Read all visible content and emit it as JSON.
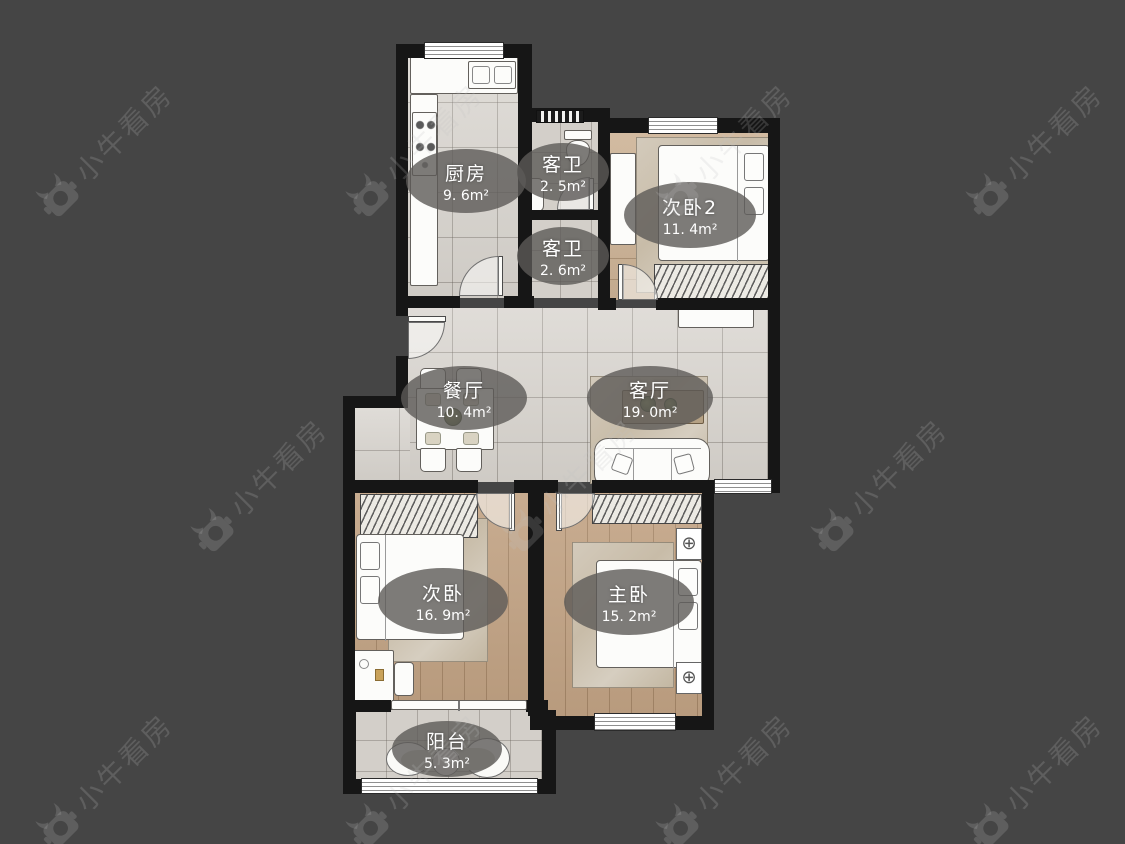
{
  "watermark": {
    "text": "小牛看房",
    "logo_icon": "bull-head-logo"
  },
  "rooms": {
    "kitchen": {
      "name": "厨房",
      "area": "9. 6m²"
    },
    "bath_upper": {
      "name": "客卫",
      "area": "2. 5m²"
    },
    "bath_lower": {
      "name": "客卫",
      "area": "2. 6m²"
    },
    "bedroom2": {
      "name": "次卧2",
      "area": "11. 4m²"
    },
    "dining": {
      "name": "餐厅",
      "area": "10. 4m²"
    },
    "living": {
      "name": "客厅",
      "area": "19. 0m²"
    },
    "bedroom": {
      "name": "次卧",
      "area": "16. 9m²"
    },
    "master": {
      "name": "主卧",
      "area": "15. 2m²"
    },
    "balcony": {
      "name": "阳台",
      "area": "5. 3m²"
    }
  },
  "icons": {
    "nightstand_lamp": "⊕"
  },
  "colors": {
    "background": "#454545",
    "wall": "#161616",
    "tile_floor": "#d7d3cd",
    "wood_floor": "#c2a384",
    "wood_floor_light": "#cdb396",
    "label_badge": "#5c5a57",
    "label_text": "#ffffff"
  }
}
